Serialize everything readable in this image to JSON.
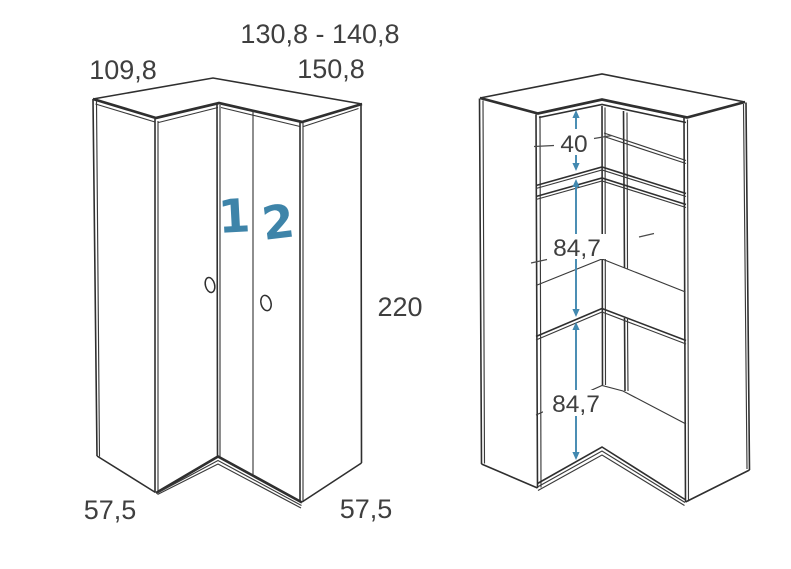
{
  "colors": {
    "line": "#2f2f2f",
    "dimension_text": "#3f3f3f",
    "accent_blue": "#4289b0",
    "door_number_blue": "#3e84a9",
    "background": "#ffffff"
  },
  "closed_unit": {
    "description": "corner wardrobe exterior view with two doors",
    "width_total_range": "130,8 - 140,8",
    "width_left_section": "109,8",
    "width_right_section": "150,8",
    "height": "220",
    "depth_left": "57,5",
    "depth_right": "57,5",
    "door_left_number": "1",
    "door_right_number": "2"
  },
  "open_unit": {
    "description": "corner wardrobe interior view with shelves",
    "top_section_height": "40",
    "middle_section_height": "84,7",
    "bottom_section_height": "84,7"
  }
}
